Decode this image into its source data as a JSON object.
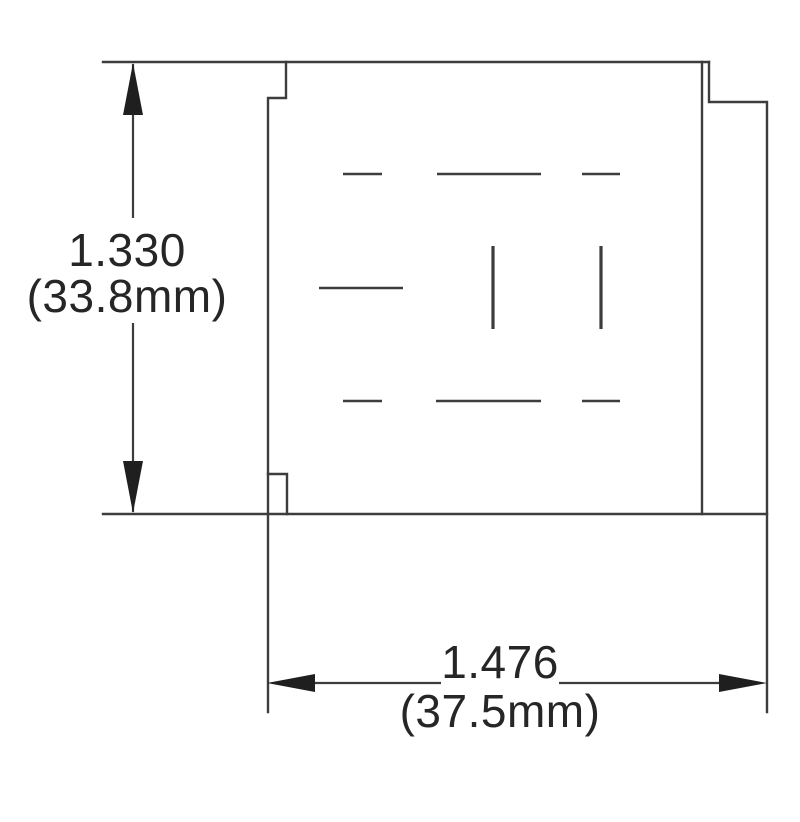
{
  "figure": {
    "background_color": "#ffffff",
    "line_color": "#3d3d3d",
    "text_color": "#262626",
    "arrow_color": "#1f1f1f",
    "vertical_dimension": {
      "inches": "1.330",
      "metric": "(33.8mm)"
    },
    "horizontal_dimension": {
      "inches": "1.476",
      "metric": "(37.5mm)"
    }
  }
}
